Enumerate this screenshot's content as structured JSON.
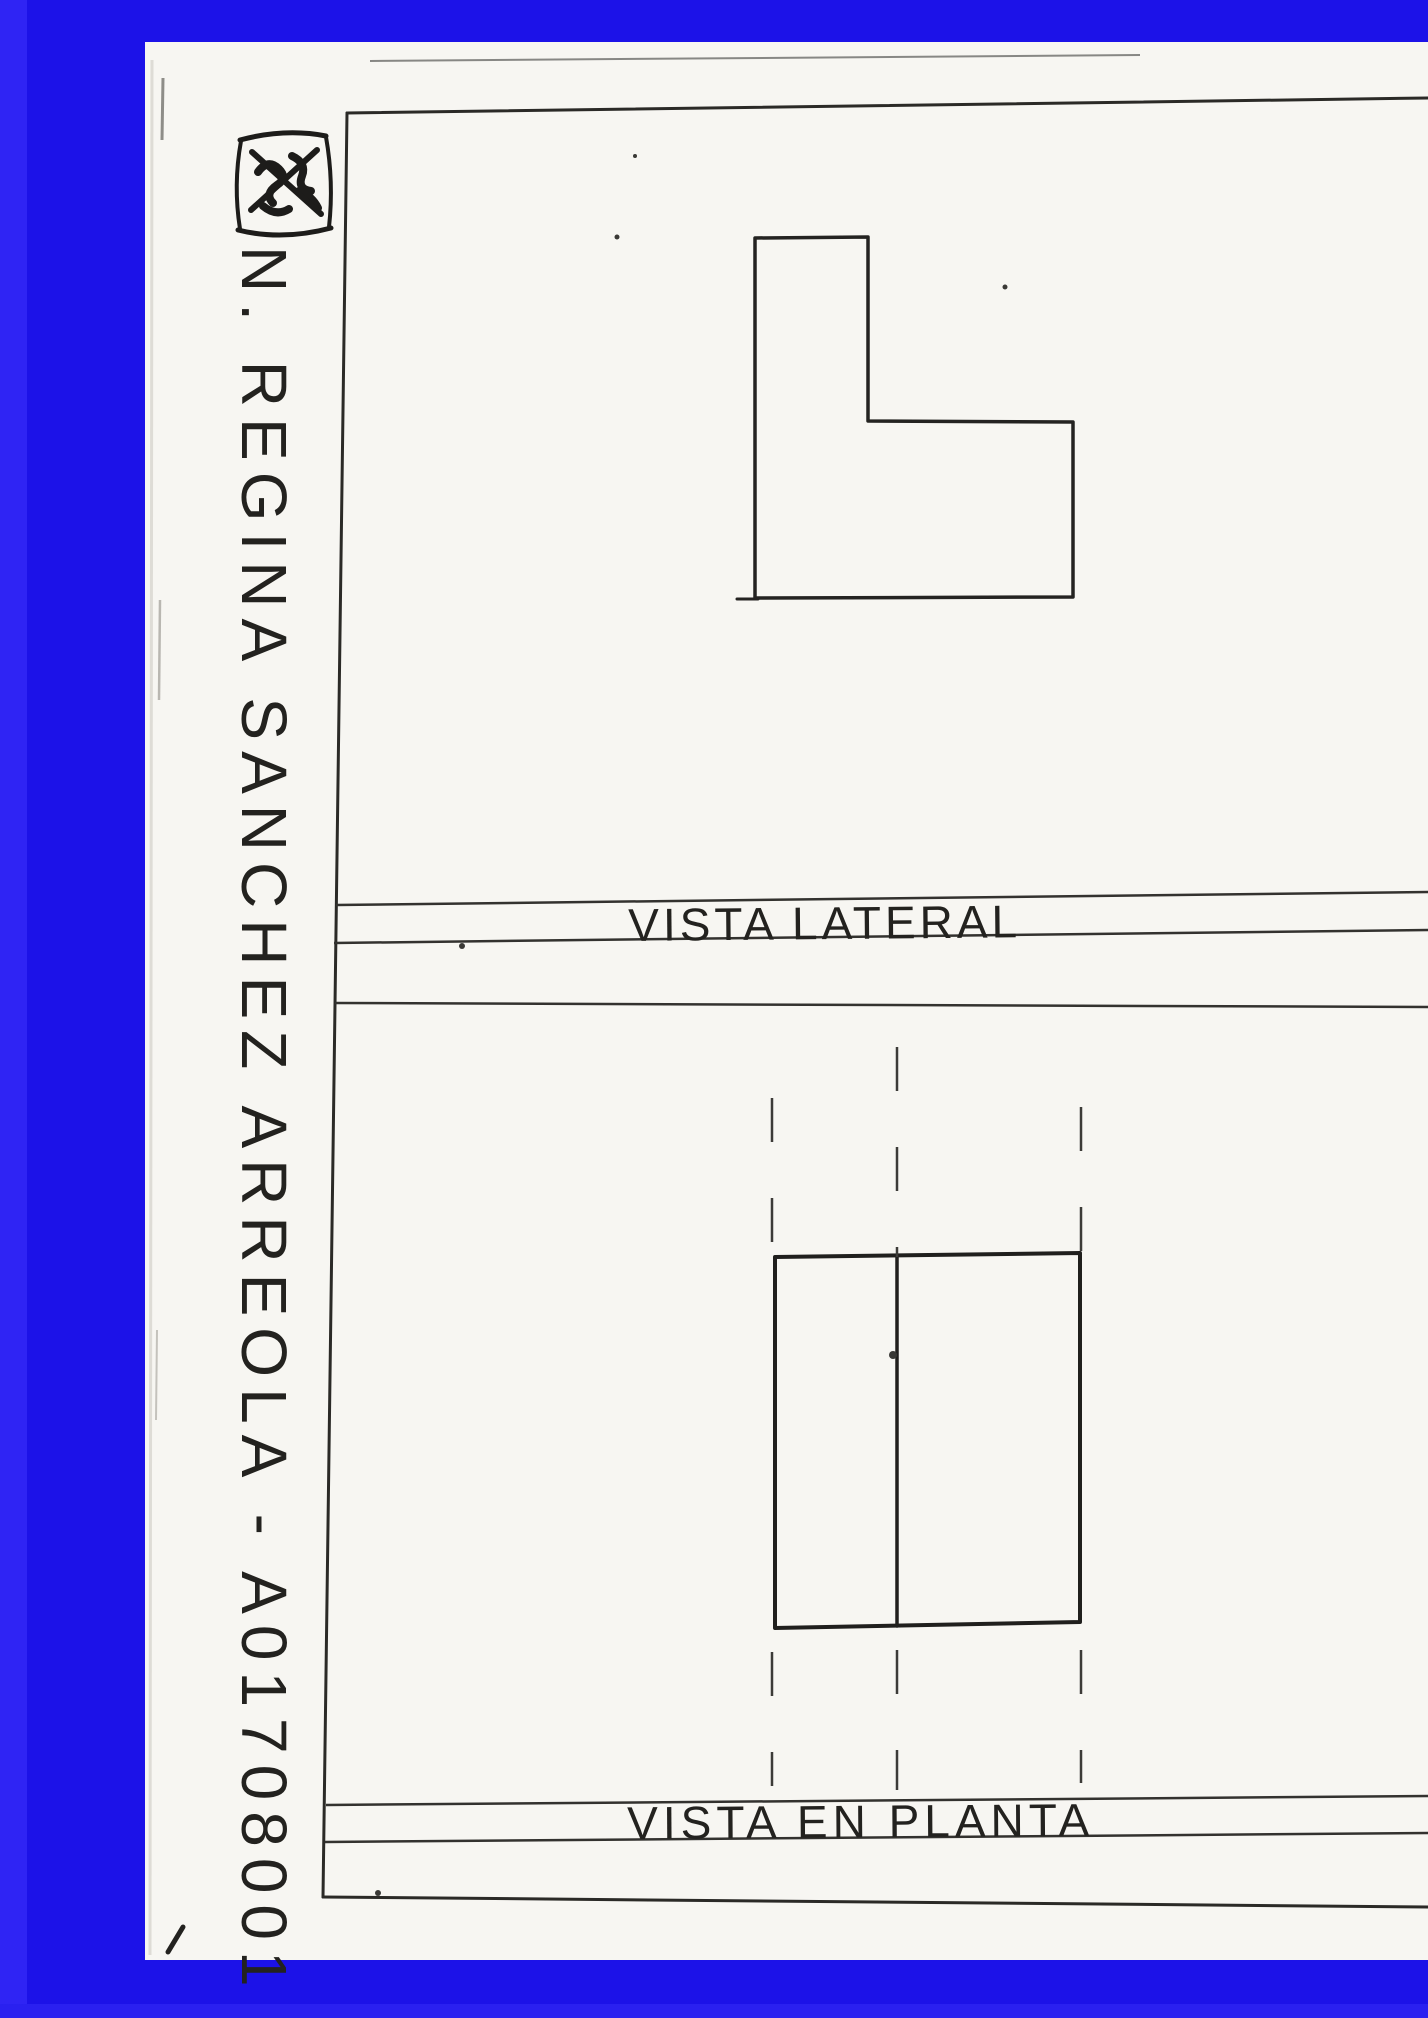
{
  "document": {
    "kind": "scanned hand-drawn orthographic projection worksheet",
    "author_line": "N. REGINA SANCHEZ ARREOLA - A01708001",
    "labels": {
      "side_view": "VISTA LATERAL",
      "plan_view": "VISTA EN PLANTA"
    },
    "colors": {
      "border_blue": "#1c12e8",
      "border_blue_light": "#2f24f4",
      "paper": "#f7f6f2",
      "ink": "#23221f"
    }
  }
}
